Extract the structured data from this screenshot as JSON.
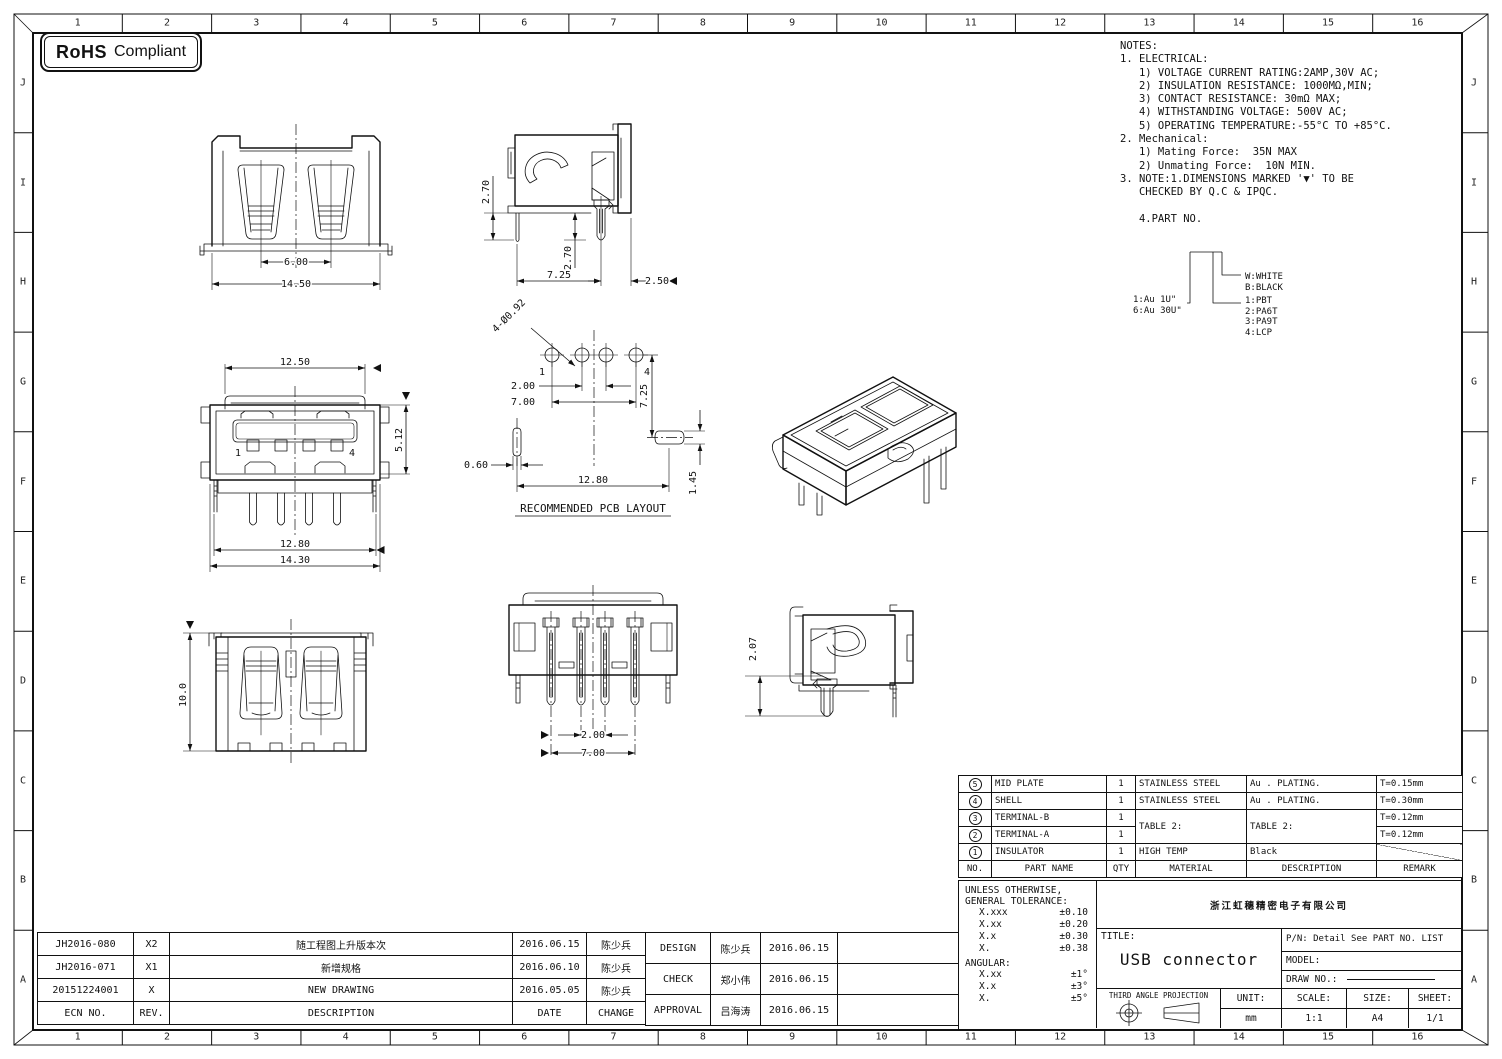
{
  "rohs": {
    "bold": "RoHS",
    "rest": "Compliant"
  },
  "border": {
    "cols": [
      "1",
      "2",
      "3",
      "4",
      "5",
      "6",
      "7",
      "8",
      "9",
      "10",
      "11",
      "12",
      "13",
      "14",
      "15",
      "16"
    ],
    "rows": [
      "J",
      "I",
      "H",
      "G",
      "F",
      "E",
      "D",
      "C",
      "B",
      "A"
    ]
  },
  "notes": {
    "lines": [
      "NOTES:",
      "1. ELECTRICAL:",
      "   1) VOLTAGE CURRENT RATING:2AMP,30V AC;",
      "   2) INSULATION RESISTANCE: 1000MΩ,MIN;",
      "   3) CONTACT RESISTANCE: 30mΩ MAX;",
      "   4) WITHSTANDING VOLTAGE: 500V AC;",
      "   5) OPERATING TEMPERATURE:-55°C TO +85°C.",
      "2. Mechanical:",
      "   1) Mating Force:  35N MAX",
      "   2) Unmating Force:  10N MIN.",
      "3. NOTE:1.DIMENSIONS MARKED '▼' TO BE",
      "   CHECKED BY Q.C & IPQC.",
      "",
      "   4.PART NO."
    ]
  },
  "part_legend": {
    "plating": [
      "1:Au 1U\"",
      "6:Au 30U\""
    ],
    "colors": [
      "W:WHITE",
      "B:BLACK"
    ],
    "materials": [
      "1:PBT",
      "2:PA6T",
      "3:PA9T",
      "4:LCP"
    ]
  },
  "views": {
    "front": {
      "dim_pitch": "6.00",
      "dim_width": "14.50"
    },
    "side_top": {
      "dim_tail_a": "2.70",
      "dim_tail_b": "2.70",
      "dim_span": "7.25",
      "dim_back": "2.50"
    },
    "top": {
      "dim_plate": "12.50",
      "dim_height": "5.12",
      "dim_legs": "12.80",
      "dim_body": "14.30",
      "pin1": "1",
      "pin4": "4"
    },
    "pcb": {
      "callout": "4-Ø0.92",
      "dim_mid": "2.00",
      "dim_outer": "7.00",
      "dim_row": "7.25",
      "dim_slot_w": "0.60",
      "dim_slots": "12.80",
      "dim_slot_h": "1.45",
      "pin1": "1",
      "pin4": "4",
      "caption": "RECOMMENDED PCB LAYOUT"
    },
    "rear": {
      "dim_height": "10.0"
    },
    "bottom": {
      "dim_mid": "2.00",
      "dim_outer": "7.00"
    },
    "side_bottom": {
      "dim_tail": "2.07"
    }
  },
  "bom": {
    "headers": [
      "NO.",
      "PART NAME",
      "QTY",
      "MATERIAL",
      "DESCRIPTION",
      "REMARK"
    ],
    "rows": [
      {
        "no": "5",
        "part": "MID PLATE",
        "qty": "1",
        "material": "STAINLESS STEEL",
        "desc": "Au . PLATING.",
        "remark": "T=0.15mm"
      },
      {
        "no": "4",
        "part": "SHELL",
        "qty": "1",
        "material": "STAINLESS STEEL",
        "desc": "Au . PLATING.",
        "remark": "T=0.30mm"
      },
      {
        "no": "3",
        "part": "TERMINAL-B",
        "qty": "1",
        "material": "TABLE 2:",
        "desc": "TABLE 2:",
        "remark": "T=0.12mm"
      },
      {
        "no": "2",
        "part": "TERMINAL-A",
        "qty": "1",
        "material": "",
        "desc": "",
        "remark": "T=0.12mm"
      },
      {
        "no": "1",
        "part": "INSULATOR",
        "qty": "1",
        "material": "HIGH TEMP",
        "desc": "Black",
        "remark": ""
      }
    ]
  },
  "tolerance": {
    "line1": "UNLESS OTHERWISE,",
    "line2": "GENERAL TOLERANCE:",
    "rows": [
      [
        "X.xxx",
        "±0.10"
      ],
      [
        "X.xx",
        "±0.20"
      ],
      [
        "X.x",
        "±0.30"
      ],
      [
        "X.",
        "±0.38"
      ]
    ],
    "angular_label": "ANGULAR:",
    "angular_rows": [
      [
        "X.xx",
        "±1°"
      ],
      [
        "X.x",
        "±3°"
      ],
      [
        "X.",
        "±5°"
      ]
    ]
  },
  "title_block": {
    "company": "浙江虹穗精密电子有限公司",
    "title_label": "TITLE:",
    "title": "USB connector",
    "pn": "P/N: Detail See PART NO. LIST",
    "model_label": "MODEL:",
    "draw_no_label": "DRAW NO.:",
    "projection_label": "THIRD ANGLE PROJECTION",
    "unit_label": "UNIT:",
    "unit": "mm",
    "scale_label": "SCALE:",
    "scale": "1:1",
    "size_label": "SIZE:",
    "size": "A4",
    "sheet_label": "SHEET:",
    "sheet": "1/1"
  },
  "revisions": {
    "headers": [
      "ECN NO.",
      "REV.",
      "DESCRIPTION",
      "DATE",
      "CHANGE"
    ],
    "rows": [
      [
        "JH2016-080",
        "X2",
        "随工程图上升版本次",
        "2016.06.15",
        "陈少兵"
      ],
      [
        "JH2016-071",
        "X1",
        "新增规格",
        "2016.06.10",
        "陈少兵"
      ],
      [
        "20151224001",
        "X",
        "NEW DRAWING",
        "2016.05.05",
        "陈少兵"
      ]
    ]
  },
  "approvals": {
    "rows": [
      [
        "DESIGN",
        "陈少兵",
        "2016.06.15"
      ],
      [
        "CHECK",
        "郑小伟",
        "2016.06.15"
      ],
      [
        "APPROVAL",
        "吕海涛",
        "2016.06.15"
      ]
    ]
  }
}
